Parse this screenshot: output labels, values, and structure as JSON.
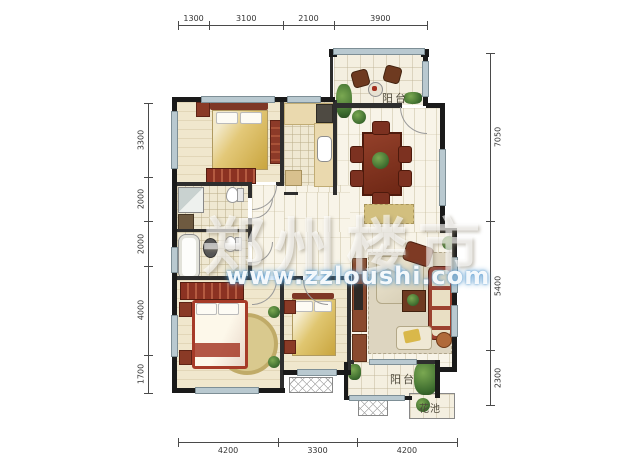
{
  "dimensions": {
    "top": {
      "segments": [
        "1300",
        "3100",
        "2100",
        "3900"
      ]
    },
    "bottom": {
      "segments": [
        "4200",
        "3300",
        "4200"
      ]
    },
    "left": {
      "segments": [
        "3300",
        "2000",
        "2000",
        "4000",
        "1700"
      ]
    },
    "right": {
      "segments": [
        "7050",
        "5400",
        "2300"
      ]
    }
  },
  "rooms": {
    "balcony_top": "阳台",
    "balcony_bottom": "阳台",
    "flower_bed": "花池"
  },
  "watermark": {
    "title": "郑州楼市",
    "url": "www.zzloushi.com"
  },
  "colors": {
    "wall": "#1a1a1a",
    "partition": "#2e2e2e",
    "window": "#b9c9d0",
    "floor_hall": "#f8f4e8",
    "floor_bedroom": "#f0e7cd",
    "floor_bath": "#efe8d2",
    "floor_balcony": "#f4efe0",
    "wood_dark": "#7c3120",
    "wood_red": "#9c4230",
    "quilt_yellow": "#d9b952",
    "rug": "#d6c37c",
    "plant": "#3f6d33",
    "watermark_glow": "#5a9bd0",
    "dimension_line": "#4a4a4a"
  }
}
